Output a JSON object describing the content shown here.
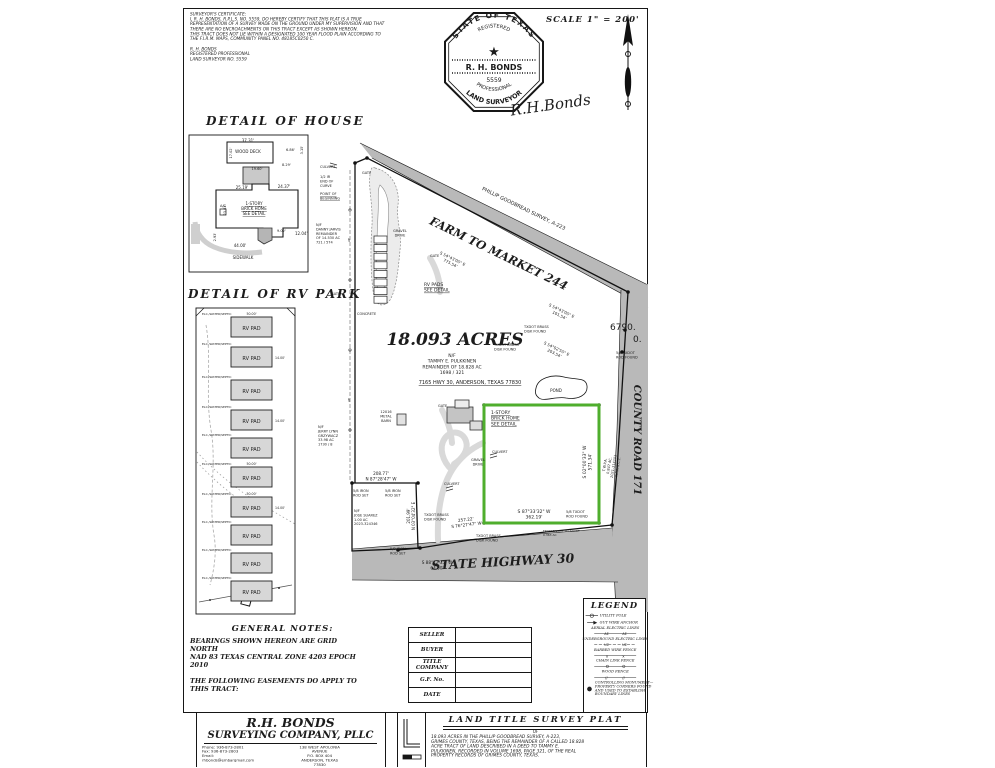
{
  "certificate": {
    "lines": [
      "SURVEYOR'S CERTIFICATE:",
      "I, R. H. BONDS, R.P.L.S. NO. 5559, DO HEREBY CERTIFY THAT THIS PLAT IS A TRUE",
      "REPRESENTATION OF A SURVEY MADE ON THE GROUND UNDER MY SUPERVISION AND THAT",
      "THERE ARE NO ENCROACHMENTS ON THIS TRACT EXCEPT AS SHOWN HEREON.",
      "THIS TRACT DOES NOT LIE WITHIN A DESIGNATED 100 YEAR FLOOD PLAIN ACCORDING TO",
      "THE F.I.R.M. MAPS, COMMUNITY PANEL NO. 48185C0250 C."
    ],
    "signoff": [
      "R. H. BONDS",
      "REGISTERED PROFESSIONAL",
      "LAND SURVEYOR NO. 5559"
    ]
  },
  "seal": {
    "arc_top": "STATE OF TEXAS",
    "arc_registered": "REGISTERED",
    "name": "R. H. BONDS",
    "number": "5559",
    "arc_professional": "PROFESSIONAL",
    "arc_surveyor": "LAND SURVEYOR",
    "signature": "R.H.Bonds"
  },
  "north": {
    "scale_label": "SCALE 1\" = 200'"
  },
  "sections": {
    "house_title": "DETAIL OF HOUSE",
    "rv_title": "DETAIL OF RV PARK"
  },
  "notes": {
    "title": "GENERAL NOTES:",
    "lines": [
      "BEARINGS SHOWN HEREON ARE  GRID",
      "NORTH",
      "NAD 83 TEXAS CENTRAL ZONE 4203 EPOCH",
      "2010",
      "",
      "THE FOLLOWING EASEMENTS DO APPLY TO",
      "THIS TRACT:"
    ]
  },
  "info_table": {
    "rows": [
      {
        "label": "SELLER",
        "value": ""
      },
      {
        "label": "BUYER",
        "value": ""
      },
      {
        "label": "TITLE\nCOMPANY",
        "value": ""
      },
      {
        "label": "G.F. No.",
        "value": ""
      },
      {
        "label": "DATE",
        "value": ""
      }
    ]
  },
  "legend": {
    "title": "LEGEND",
    "items": [
      {
        "sym": "pole",
        "lines": [
          "UTILITY POLE"
        ]
      },
      {
        "sym": "guy",
        "lines": [
          "GUY WIRE ANCHOR"
        ]
      },
      {
        "sym": "ae",
        "lines": [
          "AERIAL ELECTRIC LINES"
        ]
      },
      {
        "sym": "ue",
        "lines": [
          "UNDERGROUND ELECTRIC LINES"
        ]
      },
      {
        "sym": "barb",
        "lines": [
          "BARBED WIRE FENCE"
        ]
      },
      {
        "sym": "chain",
        "lines": [
          "CHAIN LINK FENCE"
        ]
      },
      {
        "sym": "wood",
        "lines": [
          "WOOD FENCE"
        ]
      },
      {
        "sym": "mon",
        "lines": [
          "CONTROLLING MONUMENT—",
          "PROPERTY CORNERS FOUND",
          "AND USED TO ESTABLISH",
          "BOUNDARY LINES"
        ]
      }
    ]
  },
  "title_block": {
    "company_line1": "R.H. BONDS",
    "company_line2": "SURVEYING COMPANY, PLLC",
    "contact_lines": [
      "Phone: 936-873-2801",
      "Fax:    936-873-2803",
      "Email: rhbonds@embarqmail.com"
    ],
    "address_lines": [
      "138 WEST APOLONIA AVENUE",
      "P.O. BOX 404",
      "ANDERSON, TEXAS 77830"
    ],
    "plat_title": "LAND TITLE SURVEY PLAT",
    "plat_of": "OF",
    "description_lines": [
      "18.093 ACRES IN THE PHILLIP GOODBREAD SURVEY, A-223,",
      "GRIMES COUNTY, TEXAS, BEING THE REMAINDER OF A CALLED 18.828",
      "ACRE TRACT OF LAND DESCRIBED IN A DEED TO TAMMY E.",
      "PULKKINEN, RECORDED IN VOLUME 1698, PAGE 321, OF THE REAL",
      "PROPERTY RECORDS OF GRIMES COUNTY, TEXAS."
    ]
  },
  "rv_park": {
    "pad_label": "RV PAD",
    "utility_label": "ELC./WATER/SEPTIC",
    "pads": [
      {
        "y": 317,
        "top": "50.00'"
      },
      {
        "y": 347,
        "right": "14.00'"
      },
      {
        "y": 380
      },
      {
        "y": 410,
        "right": "14.00'"
      },
      {
        "y": 438
      },
      {
        "y": 467,
        "top": "50.00'"
      },
      {
        "y": 497,
        "top": "50.00'",
        "right": "14.00'"
      },
      {
        "y": 525
      },
      {
        "y": 553
      },
      {
        "y": 581
      }
    ]
  },
  "colors": {
    "tract_green": "#4fae2d",
    "road_gray": "#b9b9b9"
  },
  "labels": [
    {
      "t": "37.31'",
      "x": 248,
      "y": 142,
      "s": 4,
      "a": "c"
    },
    {
      "t": "WOOD DECK",
      "x": 248,
      "y": 153,
      "s": 4,
      "a": "c"
    },
    {
      "t": "17.02'",
      "x": 232,
      "y": 153,
      "s": 3.5,
      "r": -90,
      "a": "c"
    },
    {
      "t": "6.86'",
      "x": 286,
      "y": 151,
      "s": 3.5
    },
    {
      "t": "3.15'",
      "x": 303,
      "y": 150,
      "s": 3.5,
      "r": -90,
      "a": "c"
    },
    {
      "t": "19.60'",
      "x": 257,
      "y": 170,
      "s": 3.5,
      "a": "c"
    },
    {
      "t": "8.29'",
      "x": 282,
      "y": 166,
      "s": 3.5
    },
    {
      "t": "25.19'",
      "x": 242,
      "y": 189,
      "s": 4,
      "a": "c"
    },
    {
      "t": "24.37'",
      "x": 284,
      "y": 188,
      "s": 4,
      "a": "c"
    },
    {
      "t": "23.03'",
      "x": 226,
      "y": 210,
      "s": 3.5,
      "r": -90,
      "a": "c"
    },
    {
      "t": "1-STORY\nBRICK HOME\nSEE DETAIL",
      "x": 254,
      "y": 205,
      "s": 4,
      "a": "c",
      "u": 1
    },
    {
      "t": "A/C",
      "x": 223,
      "y": 207,
      "s": 3.5,
      "a": "c"
    },
    {
      "t": "9.02'",
      "x": 277,
      "y": 232,
      "s": 3.5
    },
    {
      "t": "12.04'",
      "x": 295,
      "y": 235,
      "s": 4
    },
    {
      "t": "2.93'",
      "x": 216,
      "y": 237,
      "s": 3.5,
      "r": -90,
      "a": "c"
    },
    {
      "t": "44.00'",
      "x": 240,
      "y": 247,
      "s": 4,
      "a": "c"
    },
    {
      "t": "SIDEWALK",
      "x": 243,
      "y": 259,
      "s": 4,
      "a": "c"
    },
    {
      "t": "CULVERT",
      "x": 320,
      "y": 168,
      "s": 3.5
    },
    {
      "t": "GATE",
      "x": 362,
      "y": 174,
      "s": 3.5
    },
    {
      "t": "1/2 IR\nEND OF\nCURVE",
      "x": 320,
      "y": 178,
      "s": 3.5
    },
    {
      "t": "POINT OF\nBEGINNING",
      "x": 320,
      "y": 195,
      "s": 3.5,
      "u": 1
    },
    {
      "t": "N/F\nDANNY JARVIS\nREMAINDER\nOF 14.530 AC\n721 / 574",
      "x": 316,
      "y": 226,
      "s": 3.5
    },
    {
      "t": "GATE",
      "x": 331,
      "y": 295,
      "s": 3.5
    },
    {
      "t": "AE",
      "x": 350,
      "y": 240,
      "s": 3,
      "r": -90,
      "a": "c"
    },
    {
      "t": "AE",
      "x": 350,
      "y": 400,
      "s": 3,
      "r": -90,
      "a": "c"
    },
    {
      "t": "PHILLIP GOODBREAD SURVEY, A-223",
      "x": 523,
      "y": 210,
      "s": 5,
      "r": 26,
      "a": "c"
    },
    {
      "t": "FARM TO MARKET 244",
      "x": 497,
      "y": 257,
      "s": 11.5,
      "r": 26,
      "a": "c",
      "f": "t"
    },
    {
      "t": "S 54°43'05\" E\n775.54'",
      "x": 452,
      "y": 260,
      "s": 4,
      "r": 26,
      "a": "c"
    },
    {
      "t": "GRAVEL\nDRIVE",
      "x": 400,
      "y": 232,
      "s": 3.5,
      "a": "c"
    },
    {
      "t": "GATE",
      "x": 430,
      "y": 257,
      "s": 3.5
    },
    {
      "t": "RV PADS\nSEE DETAIL",
      "x": 424,
      "y": 286,
      "s": 4.5,
      "u": 1
    },
    {
      "t": "CONCRETE",
      "x": 357,
      "y": 315,
      "s": 3.5
    },
    {
      "t": "TXDOT BRASS\nDISK FOUND",
      "x": 524,
      "y": 328,
      "s": 3.5
    },
    {
      "t": "TXDOT BRASS\nDISK FOUND",
      "x": 494,
      "y": 346,
      "s": 3.5
    },
    {
      "t": "S 54°43'05\" E\n101.54'",
      "x": 561,
      "y": 312,
      "s": 4,
      "r": 26,
      "a": "c"
    },
    {
      "t": "S 54°02'55\" E\n203.54'",
      "x": 556,
      "y": 350,
      "s": 4,
      "r": 26,
      "a": "c"
    },
    {
      "t": "5/8 TXDOT\nROD FOUND",
      "x": 616,
      "y": 354,
      "s": 3.5
    },
    {
      "t": "6790.",
      "x": 610,
      "y": 330,
      "s": 9
    },
    {
      "t": "0.",
      "x": 633,
      "y": 342,
      "s": 9
    },
    {
      "t": "18.093 ACRES",
      "x": 455,
      "y": 345,
      "s": 17,
      "a": "c",
      "f": "t"
    },
    {
      "t": "N/F\nTAMMY E. PULKKINEN\nREMAINDER OF 18.828 AC\n1698 / 321",
      "x": 452,
      "y": 357,
      "s": 4.5,
      "a": "c"
    },
    {
      "t": "7165 HWY 30, ANDERSON, TEXAS 77830",
      "x": 470,
      "y": 384,
      "s": 5,
      "a": "c",
      "u": 1
    },
    {
      "t": "POND",
      "x": 556,
      "y": 392,
      "s": 4,
      "a": "c"
    },
    {
      "t": "12X16\nMETAL\nBARN",
      "x": 386,
      "y": 413,
      "s": 3.5,
      "a": "c"
    },
    {
      "t": "N/F\nJERRY LYNN\nGRZYWACZ\n33.98 AC\n1730 / 8",
      "x": 318,
      "y": 428,
      "s": 3.5
    },
    {
      "t": "GATE",
      "x": 438,
      "y": 407,
      "s": 3.5
    },
    {
      "t": "1-STORY\nBRICK HOME\nSEE DETAIL",
      "x": 491,
      "y": 414,
      "s": 4.5,
      "u": 1
    },
    {
      "t": "CULVERT",
      "x": 492,
      "y": 453,
      "s": 3.5
    },
    {
      "t": "GRAVEL\nDRIVE",
      "x": 478,
      "y": 461,
      "s": 3.5,
      "a": "c"
    },
    {
      "t": "CULVERT",
      "x": 444,
      "y": 485,
      "s": 3.5
    },
    {
      "t": "S 02°00'33\" W\n571.34'",
      "x": 586,
      "y": 462,
      "s": 4.5,
      "r": -90,
      "a": "c"
    },
    {
      "t": "T.W.P.A.\n0.847 AC.\n2021-314201\nR.P.R.G.C.T.",
      "x": 606,
      "y": 465,
      "s": 3.5,
      "r": -80,
      "a": "c"
    },
    {
      "t": "COUNTY ROAD 171",
      "x": 634,
      "y": 440,
      "s": 10,
      "r": 90,
      "a": "c",
      "f": "t"
    },
    {
      "t": "208.77'\nN 87°28'47\" W",
      "x": 381,
      "y": 475,
      "s": 4.2,
      "a": "c"
    },
    {
      "t": "5/8 IRON\nROD SET",
      "x": 353,
      "y": 492,
      "s": 3.5
    },
    {
      "t": "5/8 IRON\nROD SET",
      "x": 385,
      "y": 492,
      "s": 3.5
    },
    {
      "t": "N/F\nJOSE SUAREZ\n1.00 AC\n2023-324346",
      "x": 354,
      "y": 512,
      "s": 3.5
    },
    {
      "t": "201.99'\nN 03°04'32\" E",
      "x": 410,
      "y": 516,
      "s": 4,
      "r": -90,
      "a": "c"
    },
    {
      "t": "TXDOT BRASS\nDISK FOUND",
      "x": 424,
      "y": 516,
      "s": 3.5
    },
    {
      "t": "257.22'\nS 76°27'47\" W",
      "x": 466,
      "y": 521,
      "s": 4.2,
      "r": -7,
      "a": "c"
    },
    {
      "t": "S 87°33'32\" W\n362.19'",
      "x": 534,
      "y": 513,
      "s": 4.5,
      "a": "c"
    },
    {
      "t": "5/8 TXDOT\nROD FOUND",
      "x": 566,
      "y": 513,
      "s": 3.5
    },
    {
      "t": "TXDOT BRASS\nDISK FOUND",
      "x": 476,
      "y": 537,
      "s": 3.5
    },
    {
      "t": "FROM TAMMY TO TXDOT\n0.363 AC",
      "x": 543,
      "y": 532,
      "s": 3
    },
    {
      "t": "5/8 IRON\nROD SET",
      "x": 390,
      "y": 550,
      "s": 3.5
    },
    {
      "t": "STATE HIGHWAY 30",
      "x": 503,
      "y": 566,
      "s": 12.5,
      "r": -3,
      "a": "c",
      "f": "t"
    },
    {
      "t": "S 88°12'35\" W\n64.00'",
      "x": 437,
      "y": 564,
      "s": 4.2,
      "a": "c"
    }
  ]
}
